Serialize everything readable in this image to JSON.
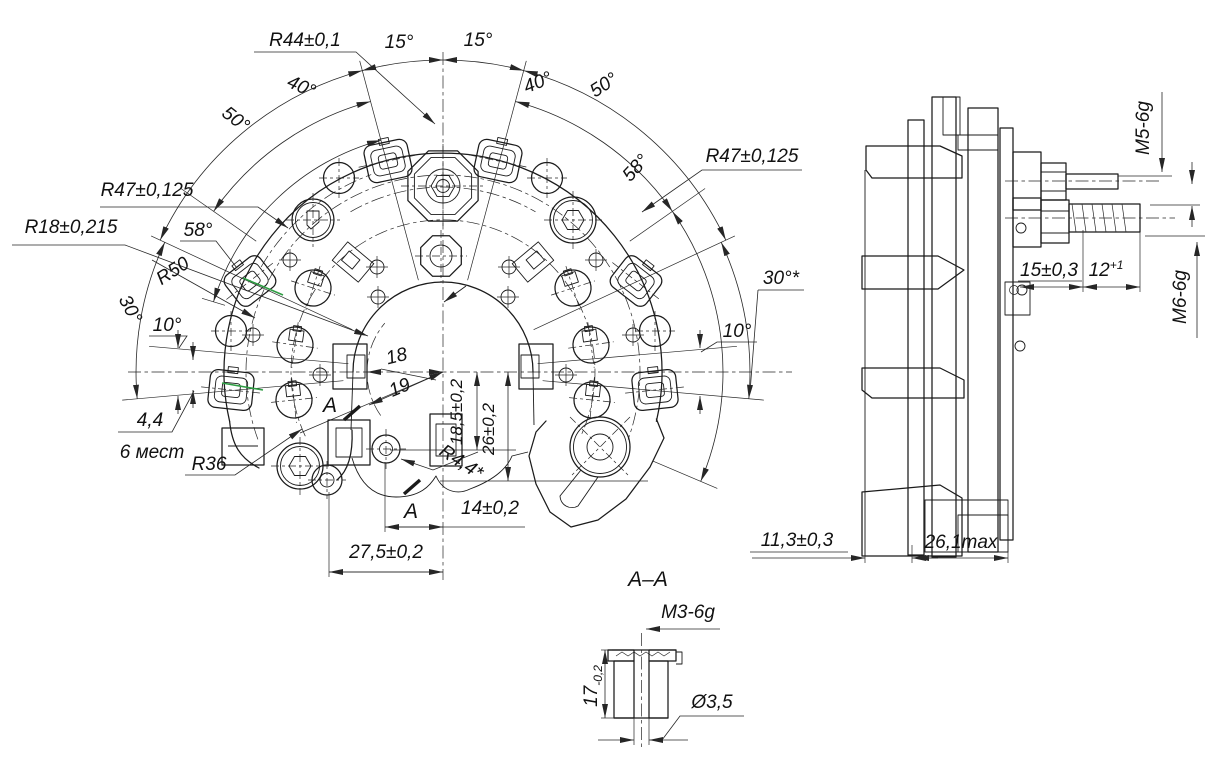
{
  "colors": {
    "line": "#1b1b1b",
    "dim": "#262626",
    "highlight": "#2f9e44",
    "background": "#ffffff"
  },
  "front": {
    "r44": "R44±0,1",
    "a15l": "15°",
    "a15r": "15°",
    "a40l": "40°",
    "a40r": "40°",
    "a50l": "50°",
    "a50r": "50°",
    "a58l": "58°",
    "a58r": "58°",
    "r47l": "R47±0,125",
    "r47r": "R47±0,125",
    "r18": "R18±0,215",
    "r50": "R50",
    "a30l": "30°",
    "a30r": "30°*",
    "a10l": "10°",
    "a10r": "10°",
    "t44": "4,4",
    "places": "6 мест",
    "r36": "R36",
    "d18": "18",
    "d19": "19",
    "d185": "18,5±0,2",
    "d26": "26±0,2",
    "r44s": "R4,4*",
    "d14": "14±0,2",
    "d275": "27,5±0,2",
    "secA": "A"
  },
  "side": {
    "m5": "M5-6g",
    "m6": "M6-6g",
    "d15": "15±0,3",
    "d12": "12",
    "d12sup": "+1",
    "d113": "11,3±0,3",
    "d261": "26,1max"
  },
  "section": {
    "title": "A–A",
    "m3": "M3-6g",
    "d17": "17",
    "d17tol": "-0,2",
    "d35": "Ø3,5"
  }
}
